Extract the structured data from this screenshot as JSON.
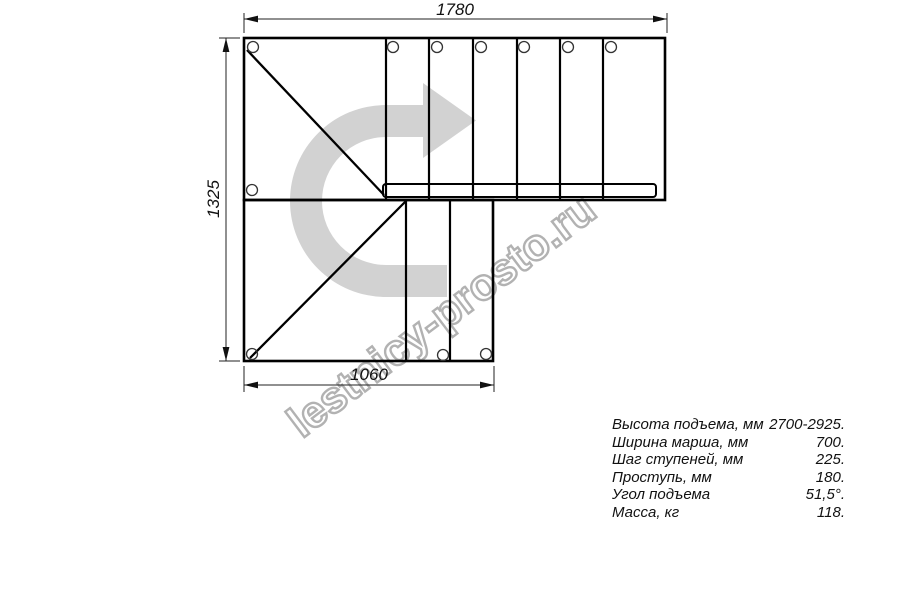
{
  "drawing": {
    "dimensions": {
      "top": "1780",
      "left": "1325",
      "bottom": "1060"
    },
    "watermark": {
      "text": "lestnicy-prosto.ru",
      "color": "#b2b2b2"
    },
    "arrow_color": "#d2d2d2",
    "line_color": "#000000"
  },
  "specs": {
    "rows": [
      {
        "label": "Высота подъема, мм",
        "value": "2700-2925."
      },
      {
        "label": "Ширина марша, мм",
        "value": "700."
      },
      {
        "label": "Шаг ступеней, мм",
        "value": "225."
      },
      {
        "label": "Проступь, мм",
        "value": "180."
      },
      {
        "label": "Угол подъема",
        "value": "51,5°."
      },
      {
        "label": "Масса, кг",
        "value": "118."
      }
    ]
  }
}
